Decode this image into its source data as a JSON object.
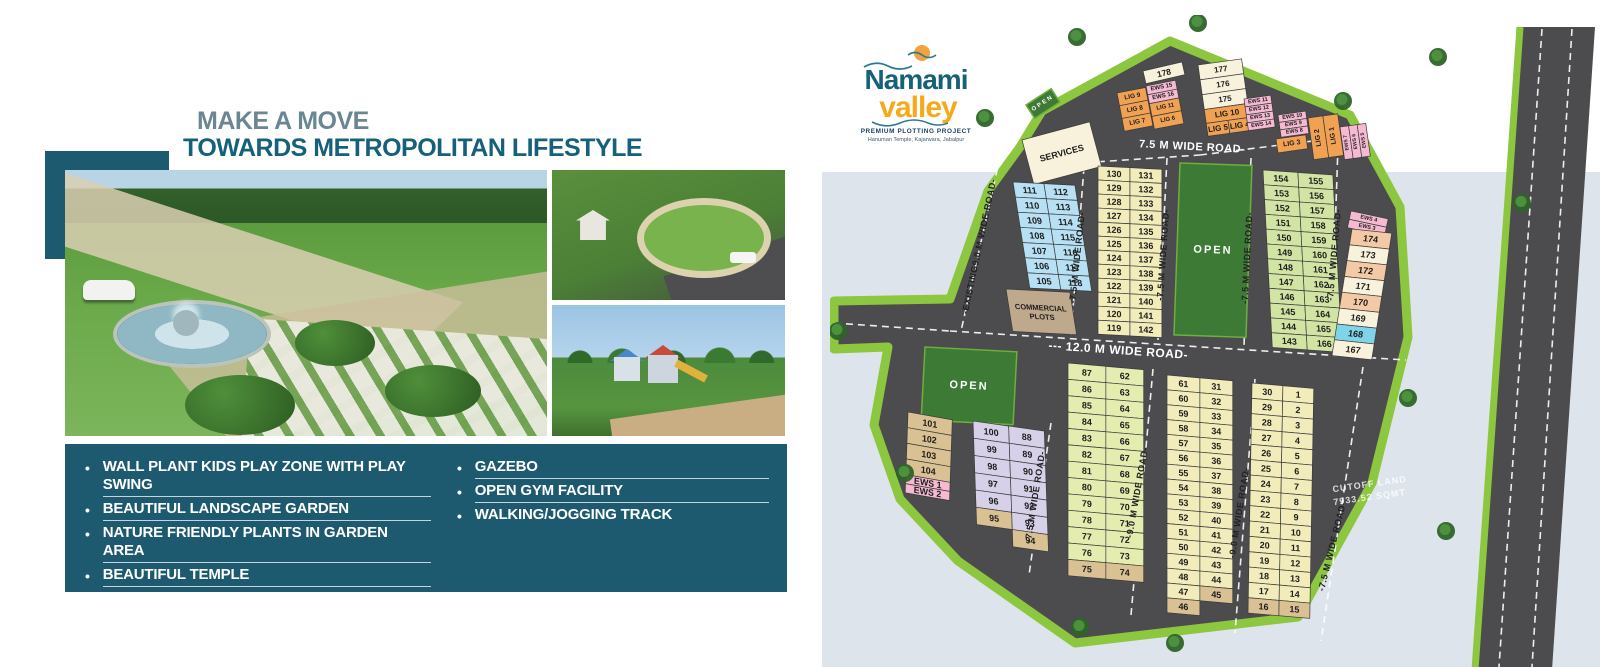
{
  "page": {
    "band_color": "#dde4eb"
  },
  "headline": {
    "line1": "MAKE A MOVE",
    "line2": "TOWARDS METROPOLITAN LIFESTYLE"
  },
  "features": {
    "left": [
      {
        "label": "WALL PLANT KIDS PLAY ZONE WITH PLAY SWING",
        "underline": true
      },
      {
        "label": "BEAUTIFUL LANDSCAPE GARDEN",
        "underline": true
      },
      {
        "label": "NATURE FRIENDLY PLANTS IN GARDEN AREA",
        "underline": true
      },
      {
        "label": "BEAUTIFUL TEMPLE",
        "underline": true
      },
      {
        "label": "WATER BODY IN GARDEN AREA",
        "underline": false
      }
    ],
    "right": [
      {
        "label": "GAZEBO",
        "underline": true
      },
      {
        "label": "OPEN GYM FACILITY",
        "underline": true
      },
      {
        "label": "WALKING/JOGGING TRACK",
        "underline": false
      }
    ]
  },
  "logo": {
    "title": "Namami",
    "subtitle": "valley",
    "tagline": "PREMIUM PLOTTING PROJECT",
    "location": "Hanuman Temple, Kajarwara, Jabalpur",
    "teal": "#15607a",
    "orange": "#f7a81b"
  },
  "map": {
    "road_color": "#4c4c4e",
    "border_color": "#8dc63f",
    "open_color": "#3c7a36",
    "colors": {
      "blue": "#b8e0f4",
      "yellow": "#f1ecba",
      "cream": "#f8f1dc",
      "green": "#d2e4a4",
      "greenyellow": "#e4ecb0",
      "lav": "#d6d1e8",
      "tan": "#d9c193",
      "pink": "#f6b9d2",
      "orange": "#f0a152",
      "peach": "#f3c9a6",
      "tealblue": "#7fd4e8",
      "brown": "#bfa98c"
    },
    "outline": "190,132 212,96 340,26 520,100 570,192 578,322 542,468 468,602 245,628 128,546 70,484 44,410 58,332 4,334 4,286 120,284 158,176",
    "right_road": "690,12 765,12 722,655 645,655",
    "right_road_edge": [
      690,
      12,
      645,
      655
    ],
    "dash_lines": [
      [
        220,
        150,
        370,
        140
      ],
      [
        370,
        140,
        515,
        122
      ],
      [
        170,
        142,
        131,
        316
      ],
      [
        254,
        152,
        241,
        320
      ],
      [
        337,
        143,
        328,
        325
      ],
      [
        421,
        143,
        414,
        331
      ],
      [
        508,
        131,
        501,
        337
      ],
      [
        4,
        308,
        120,
        316
      ],
      [
        120,
        316,
        576,
        345
      ],
      [
        221,
        408,
        199,
        560
      ],
      [
        323,
        354,
        301,
        600
      ],
      [
        425,
        364,
        405,
        618
      ],
      [
        533,
        352,
        491,
        626
      ],
      [
        712,
        14,
        669,
        652
      ],
      [
        742,
        14,
        702,
        652
      ]
    ],
    "opens": [
      {
        "x": 350,
        "y": 148,
        "w": 72,
        "h": 172,
        "rot": 2,
        "label": "OPEN"
      },
      {
        "x": 95,
        "y": 332,
        "w": 92,
        "h": 73,
        "rot": 3,
        "label": "OPEN"
      },
      {
        "x": 196,
        "y": 90,
        "w": 30,
        "h": 16,
        "rot": -33,
        "label": "OPEN",
        "small": true
      }
    ],
    "road_labels": [
      {
        "t": "-EXISTING9.0 M WIDE ROAD-",
        "x": 152,
        "y": 232,
        "rot": -78,
        "fs": 9
      },
      {
        "t": "-7.5 M WIDE ROAD-",
        "x": 250,
        "y": 243,
        "rot": -84,
        "fs": 9
      },
      {
        "t": "-7.5 M WIDE ROAD-",
        "x": 336,
        "y": 240,
        "rot": -86,
        "fs": 9
      },
      {
        "t": "-7.5 M WIDE ROAD-",
        "x": 420,
        "y": 243,
        "rot": -87,
        "fs": 9
      },
      {
        "t": "-7.5 M WIDE ROAD-",
        "x": 507,
        "y": 240,
        "rot": -85,
        "fs": 9
      },
      {
        "t": "7.5 M WIDE ROAD-",
        "x": 362,
        "y": 135,
        "rot": 3,
        "fs": 11,
        "c": "#ffffff"
      },
      {
        "t": "--- 12.0 M WIDE ROAD-",
        "x": 288,
        "y": 339,
        "rot": 4,
        "fs": 12,
        "c": "#ffffff"
      },
      {
        "t": "-7.5 M WIDE ROAD-",
        "x": 208,
        "y": 482,
        "rot": -81,
        "fs": 9
      },
      {
        "t": "-9.0 M WIDE ROAD-",
        "x": 310,
        "y": 478,
        "rot": -80,
        "fs": 9
      },
      {
        "t": "-9.0 M WIDE ROAD-",
        "x": 412,
        "y": 498,
        "rot": -81,
        "fs": 9
      },
      {
        "t": "-7.5 M WIDE ROAD-",
        "x": 505,
        "y": 532,
        "rot": -76,
        "fs": 9
      }
    ],
    "notes": [
      {
        "t": "CUTOFF LAND",
        "x": 540,
        "y": 472,
        "rot": -8
      },
      {
        "t": "7933.52 SQMT",
        "x": 540,
        "y": 485,
        "rot": -8
      }
    ],
    "trees": [
      [
        247,
        22
      ],
      [
        368,
        8
      ],
      [
        513,
        86
      ],
      [
        608,
        42
      ],
      [
        692,
        188
      ],
      [
        578,
        383
      ],
      [
        616,
        516
      ],
      [
        250,
        612
      ],
      [
        155,
        103
      ],
      [
        8,
        316
      ],
      [
        75,
        458
      ],
      [
        345,
        628
      ]
    ],
    "blocks": [
      {
        "name": "services",
        "x": 192,
        "y": 125,
        "rot": -15,
        "cw": 70,
        "ch": 46,
        "fs": 9,
        "color": "cream",
        "rows": [
          [
            "SERVICES"
          ]
        ]
      },
      {
        "name": "lig-left-a",
        "x": 287,
        "y": 78,
        "rot": -11,
        "cw": 29,
        "ch": 13,
        "fs": 6.5,
        "color": "orange",
        "rows": [
          [
            "LIG 9"
          ],
          [
            "LIG 8"
          ],
          [
            "LIG 7"
          ]
        ]
      },
      {
        "name": "lig-left-b",
        "x": 316,
        "y": 71,
        "rot": -11,
        "cw": 30,
        "ch": 13,
        "fs": 6,
        "color": "orange",
        "rh": [
          9,
          9,
          13,
          13
        ],
        "rows": [
          [
            [
              "EWS 15",
              "pink"
            ]
          ],
          [
            [
              "EWS 16",
              "pink"
            ]
          ],
          [
            "LIG 11"
          ],
          [
            "LIG 6"
          ]
        ]
      },
      {
        "name": "plot-178",
        "x": 313,
        "y": 56,
        "rot": -13,
        "cw": 40,
        "ch": 13,
        "fs": 8.5,
        "color": "cream",
        "rows": [
          [
            "178"
          ]
        ]
      },
      {
        "name": "block-175-177",
        "x": 368,
        "y": 50,
        "rot": -8,
        "cw": 44,
        "ch": 15,
        "fs": 8,
        "color": "cream",
        "rh": [
          15,
          15,
          15,
          14,
          13
        ],
        "rows": [
          [
            "177"
          ],
          [
            "176"
          ],
          [
            "175"
          ],
          [
            [
              "LIG 10",
              "orange"
            ]
          ],
          [
            [
              "LIG 5",
              "orange"
            ],
            [
              "LIG 4",
              "orange"
            ]
          ]
        ]
      },
      {
        "name": "ews-11-14",
        "x": 414,
        "y": 84,
        "rot": -8,
        "cw": 27,
        "ch": 8,
        "fs": 5.5,
        "color": "pink",
        "rows": [
          [
            "EWS 11"
          ],
          [
            "EWS 12"
          ],
          [
            "EWS 13"
          ],
          [
            "EWS 14"
          ]
        ]
      },
      {
        "name": "ews-8-10",
        "x": 448,
        "y": 100,
        "rot": -8,
        "cw": 28,
        "ch": 7.5,
        "fs": 5.5,
        "color": "pink",
        "rows": [
          [
            "EWS 10"
          ],
          [
            "EWS 9"
          ],
          [
            "EWS 8"
          ]
        ]
      },
      {
        "name": "lig-3",
        "x": 446,
        "y": 124,
        "rot": -8,
        "cw": 30,
        "ch": 14,
        "fs": 7,
        "color": "orange",
        "rows": [
          [
            "LIG 3"
          ]
        ]
      },
      {
        "name": "lig-1-2",
        "x": 478,
        "y": 103,
        "rot": -8,
        "cw": 30,
        "ch": 42,
        "fs": 7,
        "color": "orange",
        "vert": true,
        "rows": [
          [
            "LIG 2",
            "LIG 1"
          ]
        ]
      },
      {
        "name": "ews-5-7",
        "x": 510,
        "y": 112,
        "rot": -8,
        "cw": 26,
        "ch": 33,
        "fs": 5,
        "color": "pink",
        "vert": true,
        "rows": [
          [
            "EWS 7",
            "EWS 6",
            "EWS 5"
          ]
        ]
      },
      {
        "name": "col-105-118",
        "x": 183,
        "y": 167,
        "rot": 3,
        "skew": 12,
        "cw": 62,
        "ch": 15,
        "fs": 9,
        "color": "blue",
        "rows": [
          [
            "111",
            "112"
          ],
          [
            "110",
            "113"
          ],
          [
            "109",
            "114"
          ],
          [
            "108",
            "115"
          ],
          [
            "107",
            "116"
          ],
          [
            "106",
            "117"
          ],
          [
            "105",
            "118"
          ]
        ]
      },
      {
        "name": "commercial-plots",
        "x": 176,
        "y": 274,
        "rot": 3,
        "skew": 12,
        "cw": 64,
        "ch": 42,
        "fs": 7.5,
        "color": "brown",
        "rows": [
          [
            "COMMERCIAL\nPLOTS"
          ]
        ]
      },
      {
        "name": "col-119-142",
        "x": 268,
        "y": 151,
        "rot": 3,
        "skew": 3,
        "cw": 64,
        "ch": 14,
        "fs": 9,
        "color": "yellow",
        "rows": [
          [
            "130",
            "131"
          ],
          [
            "129",
            "132"
          ],
          [
            "128",
            "133"
          ],
          [
            "127",
            "134"
          ],
          [
            "126",
            "135"
          ],
          [
            "125",
            "136"
          ],
          [
            "124",
            "137"
          ],
          [
            "123",
            "138"
          ],
          [
            "122",
            "139"
          ],
          [
            "121",
            "140"
          ],
          [
            "120",
            "141"
          ],
          [
            "119",
            "142"
          ]
        ]
      },
      {
        "name": "col-143-166",
        "x": 433,
        "y": 155,
        "rot": 4,
        "skew": 7,
        "cw": 70,
        "ch": 14.7,
        "fs": 9,
        "color": "green",
        "rows": [
          [
            "154",
            "155"
          ],
          [
            "153",
            "156"
          ],
          [
            "152",
            "157"
          ],
          [
            "151",
            "158"
          ],
          [
            "150",
            "159"
          ],
          [
            "149",
            "160"
          ],
          [
            "148",
            "161"
          ],
          [
            "147",
            "162"
          ],
          [
            "146",
            "163"
          ],
          [
            "145",
            "164"
          ],
          [
            "144",
            "165"
          ],
          [
            "143",
            "166"
          ]
        ]
      },
      {
        "name": "ews-3-4",
        "x": 521,
        "y": 196,
        "rot": 12,
        "cw": 38,
        "ch": 8.5,
        "fs": 5.5,
        "color": "pink",
        "rows": [
          [
            "EWS 4"
          ],
          [
            "EWS 3"
          ]
        ]
      },
      {
        "name": "col-167-174",
        "x": 522,
        "y": 214,
        "rot": 6,
        "skew": -3,
        "cw": 40,
        "ch": 16,
        "fs": 9,
        "color": "peach",
        "rows": [
          [
            "174"
          ],
          [
            [
              "173",
              "cream"
            ]
          ],
          [
            "172"
          ],
          [
            [
              "171",
              "cream"
            ]
          ],
          [
            "170"
          ],
          [
            [
              "169",
              "cream"
            ]
          ],
          [
            [
              "168",
              "tealblue"
            ]
          ],
          [
            [
              "167",
              "cream"
            ]
          ]
        ]
      },
      {
        "name": "col-101-104",
        "x": 78,
        "y": 397,
        "rot": 10,
        "skew": 8,
        "cw": 45,
        "ch": 15.5,
        "fs": 9,
        "color": "tan",
        "rh": [
          15.5,
          15.5,
          15.5,
          15.5,
          9,
          9
        ],
        "rows": [
          [
            "101"
          ],
          [
            "102"
          ],
          [
            "103"
          ],
          [
            "104"
          ],
          [
            [
              "EWS 1",
              "pink"
            ]
          ],
          [
            [
              "EWS 2",
              "pink"
            ]
          ]
        ]
      },
      {
        "name": "col-88-100",
        "x": 143,
        "y": 406,
        "rot": 8,
        "skew": 10,
        "cw": 72,
        "ch": 17,
        "fs": 9,
        "color": "lav",
        "rows": [
          [
            "100",
            "88"
          ],
          [
            "99",
            "89"
          ],
          [
            "98",
            "90"
          ],
          [
            "97",
            "91"
          ],
          [
            "96",
            "92"
          ],
          [
            [
              "95",
              "tan"
            ],
            "93"
          ],
          [
            null,
            [
              "94",
              "tan"
            ]
          ]
        ]
      },
      {
        "name": "col-62-87",
        "x": 238,
        "y": 348,
        "rot": 5,
        "skew": 5,
        "cw": 76,
        "ch": 16.3,
        "fs": 9,
        "color": "greenyellow",
        "rows": [
          [
            "87",
            "62"
          ],
          [
            "86",
            "63"
          ],
          [
            "85",
            "64"
          ],
          [
            "84",
            "65"
          ],
          [
            "83",
            "66"
          ],
          [
            "82",
            "67"
          ],
          [
            "81",
            "68"
          ],
          [
            "80",
            "69"
          ],
          [
            "79",
            "70"
          ],
          [
            "78",
            "71"
          ],
          [
            "77",
            "72"
          ],
          [
            "76",
            "73"
          ],
          [
            [
              "75",
              "tan"
            ],
            [
              "74",
              "tan"
            ]
          ]
        ]
      },
      {
        "name": "col-31-61",
        "x": 337,
        "y": 360,
        "rot": 5,
        "skew": 5,
        "cw": 66,
        "ch": 14.8,
        "fs": 9,
        "color": "yellow",
        "rows": [
          [
            "61",
            "31"
          ],
          [
            "60",
            "32"
          ],
          [
            "59",
            "33"
          ],
          [
            "58",
            "34"
          ],
          [
            "57",
            "35"
          ],
          [
            "56",
            "36"
          ],
          [
            "55",
            "37"
          ],
          [
            "54",
            "38"
          ],
          [
            "53",
            "39"
          ],
          [
            "52",
            "40"
          ],
          [
            "51",
            "41"
          ],
          [
            "50",
            "42"
          ],
          [
            "49",
            "43"
          ],
          [
            "48",
            "44"
          ],
          [
            "47",
            [
              "45",
              "tan"
            ]
          ],
          [
            [
              "46",
              "tan"
            ],
            null
          ]
        ]
      },
      {
        "name": "col-1-30",
        "x": 422,
        "y": 368,
        "rot": 5,
        "skew": 4,
        "cw": 62,
        "ch": 15.3,
        "fs": 9,
        "color": "yellow",
        "rows": [
          [
            "30",
            "1"
          ],
          [
            "29",
            "2"
          ],
          [
            "28",
            "3"
          ],
          [
            "27",
            "4"
          ],
          [
            "26",
            "5"
          ],
          [
            "25",
            "6"
          ],
          [
            "24",
            "7"
          ],
          [
            "23",
            "8"
          ],
          [
            "22",
            "9"
          ],
          [
            "21",
            "10"
          ],
          [
            "20",
            "11"
          ],
          [
            "19",
            "12"
          ],
          [
            "18",
            "13"
          ],
          [
            "17",
            "14"
          ],
          [
            [
              "16",
              "tan"
            ],
            [
              "15",
              "tan"
            ]
          ]
        ]
      }
    ]
  }
}
